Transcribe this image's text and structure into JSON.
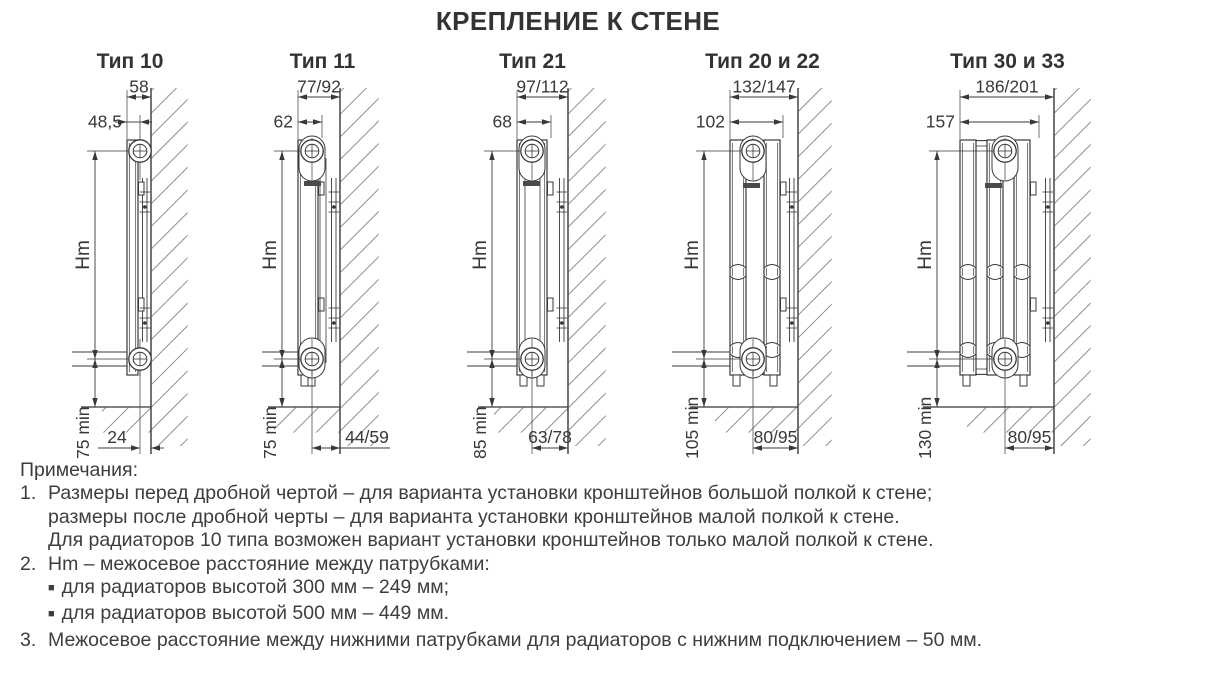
{
  "title": "КРЕПЛЕНИЕ К СТЕНЕ",
  "colors": {
    "ink": "#383838",
    "hatch": "#8f8f8f",
    "logo": "#4a4a4a",
    "text": "#3d3d3d"
  },
  "figures": [
    {
      "id": "tip-10",
      "heading": "Тип 10",
      "dims": {
        "total_depth": "58",
        "front_to_axis": "48,5",
        "axis_spacing": "Hm",
        "floor_clearance": "75 min",
        "axis_to_wall": "24"
      },
      "geo": {
        "left": 60,
        "width": 140,
        "frontX": 67,
        "rearX": 78,
        "pipeX": 80,
        "depthX": 80,
        "wallX": 91,
        "hmX": 35,
        "hatchW": 36,
        "panels": [
          [
            67,
            78
          ]
        ],
        "lines": [],
        "boss": false,
        "logo": null,
        "wavy": false,
        "feet": false,
        "bottomLabel": "left"
      }
    },
    {
      "id": "tip-11",
      "heading": "Тип 11",
      "dims": {
        "total_depth": "77/92",
        "front_to_axis": "62",
        "axis_spacing": "Hm",
        "floor_clearance": "75 min",
        "axis_to_wall": "44/59"
      },
      "geo": {
        "left": 250,
        "width": 145,
        "frontX": 48,
        "rearX": 68,
        "pipeX": 62,
        "depthX": 72,
        "wallX": 90,
        "hmX": 32,
        "hatchW": 38,
        "panels": [
          [
            48,
            68
          ]
        ],
        "lines": [
          [
            70,
            78,
            283
          ],
          [
            76,
            78,
            283
          ]
        ],
        "boss": true,
        "logo": [
          54,
          101
        ],
        "wavy": false,
        "feet": true,
        "bottomLabel": "right"
      }
    },
    {
      "id": "tip-21",
      "heading": "Тип 21",
      "dims": {
        "total_depth": "97/112",
        "front_to_axis": "68",
        "axis_spacing": "Hm",
        "floor_clearance": "85 min",
        "axis_to_wall": "63/78"
      },
      "geo": {
        "left": 455,
        "width": 155,
        "frontX": 62,
        "rearX": 92,
        "pipeX": 77,
        "depthX": 96,
        "wallX": 113,
        "hmX": 37,
        "hatchW": 37,
        "panels": [
          [
            62,
            92
          ]
        ],
        "lines": [
          [
            70,
            78,
            272
          ],
          [
            85,
            78,
            272
          ]
        ],
        "boss": true,
        "logo": [
          68,
          101
        ],
        "wavy": false,
        "feet": true,
        "bottomLabel": "center"
      }
    },
    {
      "id": "tip-20-22",
      "heading": "Тип 20 и 22",
      "dims": {
        "total_depth": "132/147",
        "front_to_axis": "102",
        "axis_spacing": "Hm",
        "floor_clearance": "105 min",
        "axis_to_wall": "80/95"
      },
      "geo": {
        "left": 660,
        "width": 205,
        "frontX": 70,
        "rearX": 120,
        "pipeX": 93,
        "depthX": 123,
        "wallX": 138,
        "hmX": 44,
        "hatchW": 33,
        "panels": [
          [
            70,
            86
          ],
          [
            104,
            120
          ]
        ],
        "lines": [],
        "boss": true,
        "logo": [
          83,
          103
        ],
        "wavy": true,
        "feet": true,
        "bottomLabel": "center"
      }
    },
    {
      "id": "tip-30-33",
      "heading": "Тип 30 и 33",
      "dims": {
        "total_depth": "186/201",
        "front_to_axis": "157",
        "axis_spacing": "Hm",
        "floor_clearance": "130 min",
        "axis_to_wall": "80/95"
      },
      "geo": {
        "left": 895,
        "width": 225,
        "frontX": 65,
        "rearX": 135,
        "pipeX": 110,
        "depthX": 144,
        "wallX": 159,
        "hmX": 42,
        "hatchW": 36,
        "panels": [
          [
            65,
            81
          ],
          [
            92,
            108
          ],
          [
            119,
            135
          ]
        ],
        "lines": [],
        "boss": true,
        "logo": [
          90,
          103
        ],
        "wavy": true,
        "feet": true,
        "bottomLabel": "center"
      }
    }
  ],
  "notes": {
    "heading": "Примечания:",
    "bullet_char": "■",
    "items": [
      {
        "num": "1.",
        "lines": [
          "Размеры перед дробной чертой – для варианта установки кронштейнов большой полкой к стене;",
          "размеры после дробной черты – для варианта установки кронштейнов малой полкой к стене.",
          "Для радиаторов 10 типа возможен вариант установки кронштейнов только малой полкой к стене."
        ]
      },
      {
        "num": "2.",
        "lines": [
          "Hm – межосевое расстояние между патрубками:"
        ],
        "bullets": [
          "для радиаторов высотой 300 мм – 249 мм;",
          "для радиаторов высотой 500 мм – 449 мм."
        ]
      },
      {
        "num": "3.",
        "lines": [
          "Межосевое расстояние между нижними патрубками для радиаторов с нижним подключением – 50 мм."
        ]
      }
    ]
  }
}
